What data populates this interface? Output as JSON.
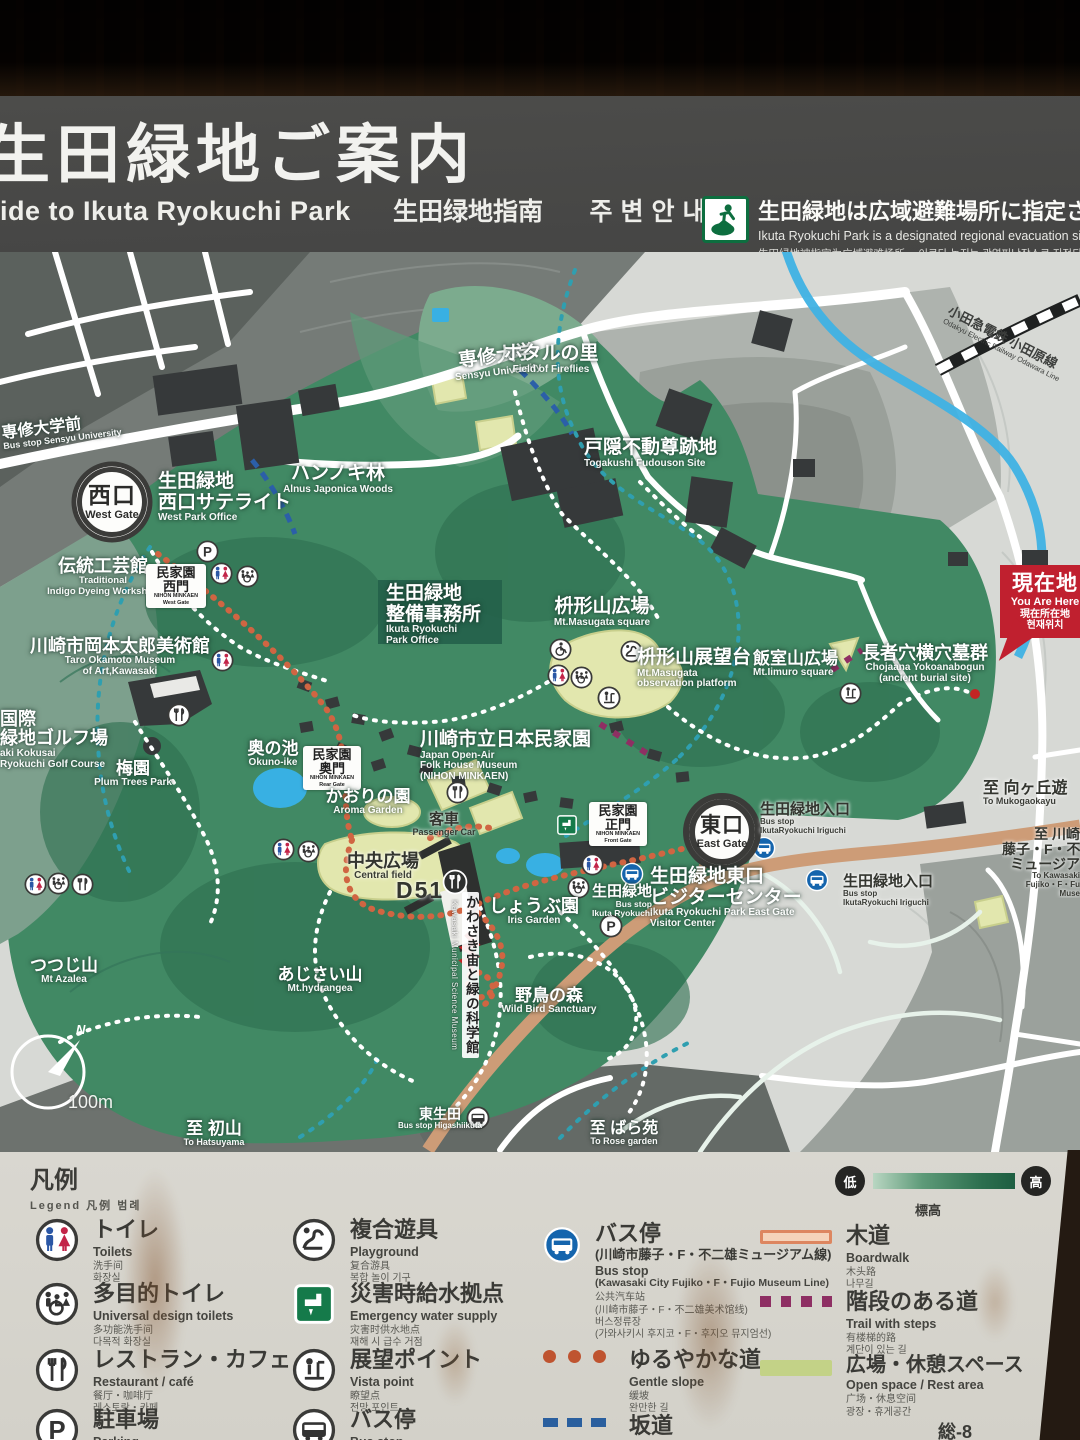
{
  "header": {
    "title_jp": "生田緑地ご案内",
    "subtitle_en": "ide to Ikuta Ryokuchi Park",
    "subtitle_zh": "生田绿地指南",
    "subtitle_kr": "주변안내",
    "evacuation": {
      "jp": "生田緑地は広域避難場所に指定されて",
      "en": "Ikuta Ryokuchi Park is a designated regional evacuation site.",
      "zh_kr": "生田绿地被指定为广域避难场所。 이쿠타 녹지는 광역피난장소로 지정되어 있습"
    }
  },
  "map": {
    "compass_n": "N",
    "scale": "100m",
    "labels": {
      "sensyu_university": {
        "jp": "専修大学",
        "en": "Sensyu University"
      },
      "bus_sensyu": {
        "jp": "専修大学前",
        "en": "Bus stop Sensyu University"
      },
      "west_gate": {
        "jp": "西口",
        "en": "West Gate"
      },
      "west_park_office": {
        "jp1": "生田緑地",
        "jp2": "西口サテライト",
        "en": "West Park Office"
      },
      "alnus_woods": {
        "jp": "ハンノキ林",
        "en": "Alnus Japonica Woods"
      },
      "fireflies": {
        "jp": "ホタルの里",
        "en": "Field of Fireflies"
      },
      "togakushi": {
        "jp": "戸隠不動尊跡地",
        "en": "Togakushi Fudouson Site"
      },
      "railway": {
        "jp": "小田急電鉄 小田原線",
        "en": "Odakyu Electric Railway Odawara Line"
      },
      "indigo": {
        "jp": "伝統工芸館",
        "en1": "Traditional",
        "en2": "Indigo Dyeing Workshop"
      },
      "minkaen_west_gate": {
        "jp1": "民家園",
        "jp2": "西門",
        "sub1": "NIHON MINKAEN",
        "sub2": "West Gate"
      },
      "park_office": {
        "jp1": "生田緑地",
        "jp2": "整備事務所",
        "en1": "Ikuta Ryokuchi",
        "en2": "Park Office"
      },
      "masugata_square": {
        "jp": "枡形山広場",
        "en": "Mt.Masugata square"
      },
      "masugata_obs": {
        "jp": "枡形山展望台",
        "en1": "Mt.Masugata",
        "en2": "observation platform"
      },
      "iimuro": {
        "jp": "飯室山広場",
        "en": "Mt.Iimuro square"
      },
      "burial": {
        "jp": "長者穴横穴墓群",
        "en1": "Chojaana Yokoanabogun",
        "en2": "(ancient burial site)"
      },
      "taro_museum": {
        "jp": "川崎市岡本太郎美術館",
        "en1": "Taro Okamoto Museum",
        "en2": "of Art,Kawasaki"
      },
      "golf": {
        "jp1": "国際",
        "jp2": "緑地ゴルフ場",
        "en1": "aki Kokusai",
        "en2": "Ryokuchi Golf Course"
      },
      "okuno_ike": {
        "jp": "奥の池",
        "en": "Okuno-ike"
      },
      "minkaen_rear_gate": {
        "jp1": "民家園",
        "jp2": "奥門",
        "sub1": "NIHON MINKAEN",
        "sub2": "Rear Gate"
      },
      "plum": {
        "jp": "梅園",
        "en": "Plum Trees Park"
      },
      "minkaen": {
        "jp": "川崎市立日本民家園",
        "en1": "Japan Open-Air",
        "en2": "Folk House Museum",
        "en3": "(NIHON MINKAEN)"
      },
      "aroma": {
        "jp": "かおりの園",
        "en": "Aroma Garden"
      },
      "passenger_car": {
        "jp": "客車",
        "en": "Passenger Car"
      },
      "central_field": {
        "jp": "中央広場",
        "en": "Central field"
      },
      "d51": {
        "label": "D51"
      },
      "science_museum": {
        "jp": "かわさき宙と緑の科学館",
        "en": "Kawasaki Municipal Science Museum"
      },
      "iris": {
        "jp": "しょうぶ園",
        "en": "Iris Garden"
      },
      "wild_bird": {
        "jp": "野鳥の森",
        "en": "Wild Bird Sanctuary"
      },
      "azalea": {
        "jp": "つつじ山",
        "en": "Mt Azalea"
      },
      "hydrangea": {
        "jp": "あじさい山",
        "en": "Mt.hydrangea"
      },
      "east_gate": {
        "jp": "東口",
        "en": "East Gate"
      },
      "minkaen_front_gate": {
        "jp1": "民家園",
        "jp2": "正門",
        "sub1": "NIHON MINKAEN",
        "sub2": "Front Gate"
      },
      "visitor_center": {
        "jp1": "生田緑地東口",
        "jp2": "ビジターセンター",
        "en1": "Ikuta Ryokuchi Park East Gate",
        "en2": "Visitor Center"
      },
      "bus_ikuta": {
        "jp": "生田緑地",
        "en1": "Bus stop",
        "en2": "Ikuta Ryokuchi"
      },
      "bus_iriguchi": {
        "jp": "生田緑地入口",
        "en1": "Bus stop",
        "en2": "IkutaRyokuchi Iriguchi"
      },
      "to_mukogaoka": {
        "jp": "至 向ヶ丘遊",
        "en": "To Mukogaokayu"
      },
      "to_kawasaki_fujiko": {
        "jp1": "至 川崎",
        "jp2": "藤子・F・不二",
        "jp3": "ミュージア",
        "en1": "To Kawasaki",
        "en2": "Fujiko・F・Fu",
        "en3": "Muse"
      },
      "you_are_here": {
        "jp": "現在地",
        "en": "You Are Here",
        "zh": "現在所在地",
        "kr": "현재위치"
      },
      "to_hatsuyama": {
        "jp": "至 初山",
        "en": "To Hatsuyama"
      },
      "bus_higashiikuta": {
        "jp": "東生田",
        "en": "Bus stop Higashiikuta"
      },
      "to_rose": {
        "jp": "至 ばら苑",
        "en": "To Rose garden"
      }
    }
  },
  "legend": {
    "title_jp": "凡例",
    "title_sub": "Legend  凡例  범례",
    "elevation": {
      "low": "低",
      "high": "高",
      "label": "標高"
    },
    "col1": [
      {
        "icon": "toilets-icon",
        "jp": "トイレ",
        "en": "Toilets",
        "zh": "洗手间",
        "kr": "화장실"
      },
      {
        "icon": "universal-toilets-icon",
        "jp": "多目的トイレ",
        "en": "Universal design toilets",
        "zh": "多功能洗手间",
        "kr": "다목적 화장실"
      },
      {
        "icon": "restaurant-icon",
        "jp": "レストラン・カフェ",
        "en": "Restaurant / café",
        "zh": "餐厅・咖啡厅",
        "kr": "레스토랑・카페"
      },
      {
        "icon": "parking-icon",
        "jp": "駐車場",
        "en": "Parking"
      }
    ],
    "col2": [
      {
        "icon": "playground-icon",
        "jp": "複合遊具",
        "en": "Playground",
        "zh": "复合游具",
        "kr": "복합 놀이 기구"
      },
      {
        "icon": "emergency-water-icon",
        "jp": "災害時給水拠点",
        "en": "Emergency water supply",
        "zh": "灾害时供水地点",
        "kr": "재해 시 급수 거점"
      },
      {
        "icon": "vista-point-icon",
        "jp": "展望ポイント",
        "en": "Vista point",
        "zh": "瞭望点",
        "kr": "전망 포인트"
      },
      {
        "icon": "bus-stop-icon",
        "jp": "バス停",
        "en": "Bus stop"
      }
    ],
    "col3": [
      {
        "icon": "museum-bus-icon",
        "jp": "バス停",
        "jp2": "(川崎市藤子・F・不二雄ミュージアム線)",
        "en": "Bus stop",
        "en2": "(Kawasaki City Fujiko・F・Fujio Museum Line)",
        "zh": "公共汽车站",
        "zh2": "(川崎市藤子・F・不二雄美术馆线)",
        "kr": "버스정류장",
        "kr2": "(가와사키시 후지코・F・후지오 뮤지엄선)"
      },
      {
        "swatch": "gentle-slope",
        "jp": "ゆるやかな道",
        "en": "Gentle slope",
        "zh": "缓坡",
        "kr": "완만한 길"
      },
      {
        "swatch": "slope",
        "jp": "坂道",
        "en": "Slope"
      }
    ],
    "col4": [
      {
        "swatch": "boardwalk",
        "jp": "木道",
        "en": "Boardwalk",
        "zh": "木头路",
        "kr": "나무길"
      },
      {
        "swatch": "trail-with-steps",
        "jp": "階段のある道",
        "en": "Trail with steps",
        "zh": "有楼梯的路",
        "kr": "계단이 있는 길"
      },
      {
        "swatch": "open-space",
        "jp": "広場・休憩スペース",
        "en": "Open space / Rest area",
        "zh": "广场・休息空间",
        "kr": "광장・휴게공간"
      }
    ],
    "page_code": "総-8"
  }
}
